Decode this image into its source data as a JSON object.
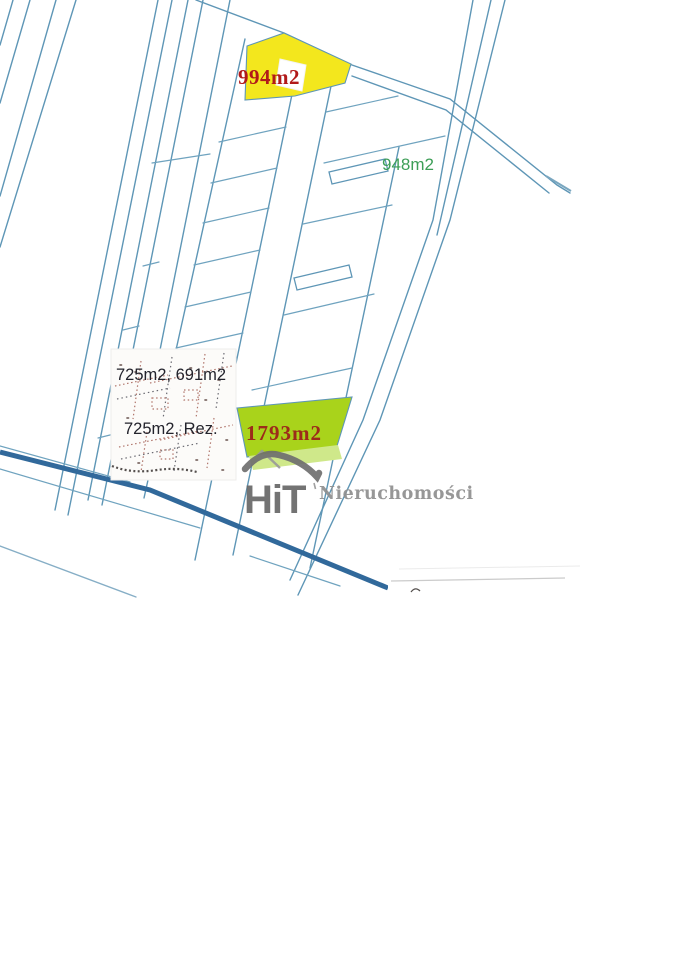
{
  "labels": {
    "yellow_parcel_area": "994m2",
    "right_parcel_area": "948m2",
    "green_parcel_area": "1793m2",
    "inset_areas_top": "725m2, 691m2",
    "inset_areas_bottom": "725m2, Rez."
  },
  "watermark": {
    "logo": "HiT",
    "name": "Nieruchomości"
  },
  "colors": {
    "parcel_highlight_yellow": "#f3e71d",
    "parcel_highlight_green": "#a9d31b",
    "parcel_highlight_green_light": "#cfe88a",
    "area_label_red": "#b11a1a",
    "area_label_dark_red": "#9c2c1a",
    "area_label_green": "#3d9e57",
    "area_label_dark": "#23232c",
    "map_line_blue": "#5e96b6",
    "road_dark_blue": "#31699b",
    "watermark_gray": "#8f8f8f",
    "logo_gray": "#686868"
  }
}
